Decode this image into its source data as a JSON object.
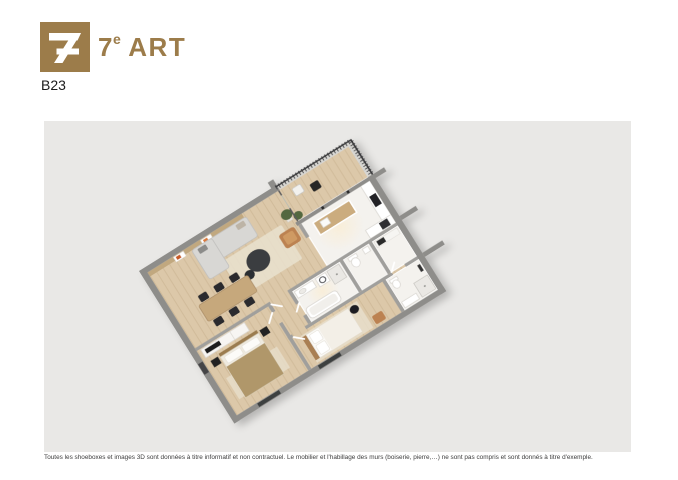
{
  "brand": {
    "title_number": "7",
    "title_superscript": "e",
    "title_word": "ART",
    "logo_glyph": "crossed-seven-monogram"
  },
  "unit_reference": "B23",
  "disclaimer": {
    "text": "Toutes les shoeboxes et images 3D sont données à titre informatif et non contractuel. Le mobilier et l'habillage des murs (boiserie, pierre,…) ne sont pas compris et sont donnés à titre d'exemple."
  },
  "floorplan": {
    "kind": "3d-isometric-apartment-floorplan",
    "visible_elements": [
      "balcony-with-dark-railing",
      "balcony-chairs",
      "potted-plant",
      "wood-panel-wall-with-art",
      "l-shaped-gray-sofa",
      "round-dark-coffee-table",
      "beige-rug",
      "tan-armchair",
      "wood-dining-table-six-black-chairs",
      "kitchen-island-wood-counter",
      "cooktop",
      "wardrobe-with-tv",
      "bedroom-gold-bed",
      "bedroom-white-bed-wood-frame",
      "bathtub",
      "shower",
      "washing-machine",
      "sink",
      "wc-toilet",
      "second-bathroom",
      "corridor",
      "entry-door",
      "windows"
    ]
  },
  "colors": {
    "brand-gold": "#9c7c4a",
    "text-dark": "#1b1b1b",
    "canvas-bg": "#e9e8e6",
    "wall-gray": "#8e8d8a",
    "inner-wall": "#a09f9c",
    "wood-floor": "#dcc8a9",
    "wood-line": "#cdb795",
    "white-floor": "#f4f2ee",
    "balcony-floor": "#d7d6d2",
    "balcony-line": "#c8c7c3",
    "railing-dark": "#3a3a3c",
    "sofa-gray": "#d8d7d4",
    "rug-beige": "#e8e0cd",
    "table-dark": "#3a3c3f",
    "chair-black": "#2b2b2d",
    "wood-furniture": "#c6a87c",
    "tan-leather": "#bc8251",
    "bed-gold": "#b0976a",
    "bed-white": "#fbfaf7",
    "headboard-wood": "#a97f52",
    "plant-green": "#53683f",
    "window-dark": "#3d3f41",
    "disclaimer-text": "#3c3c3c"
  }
}
